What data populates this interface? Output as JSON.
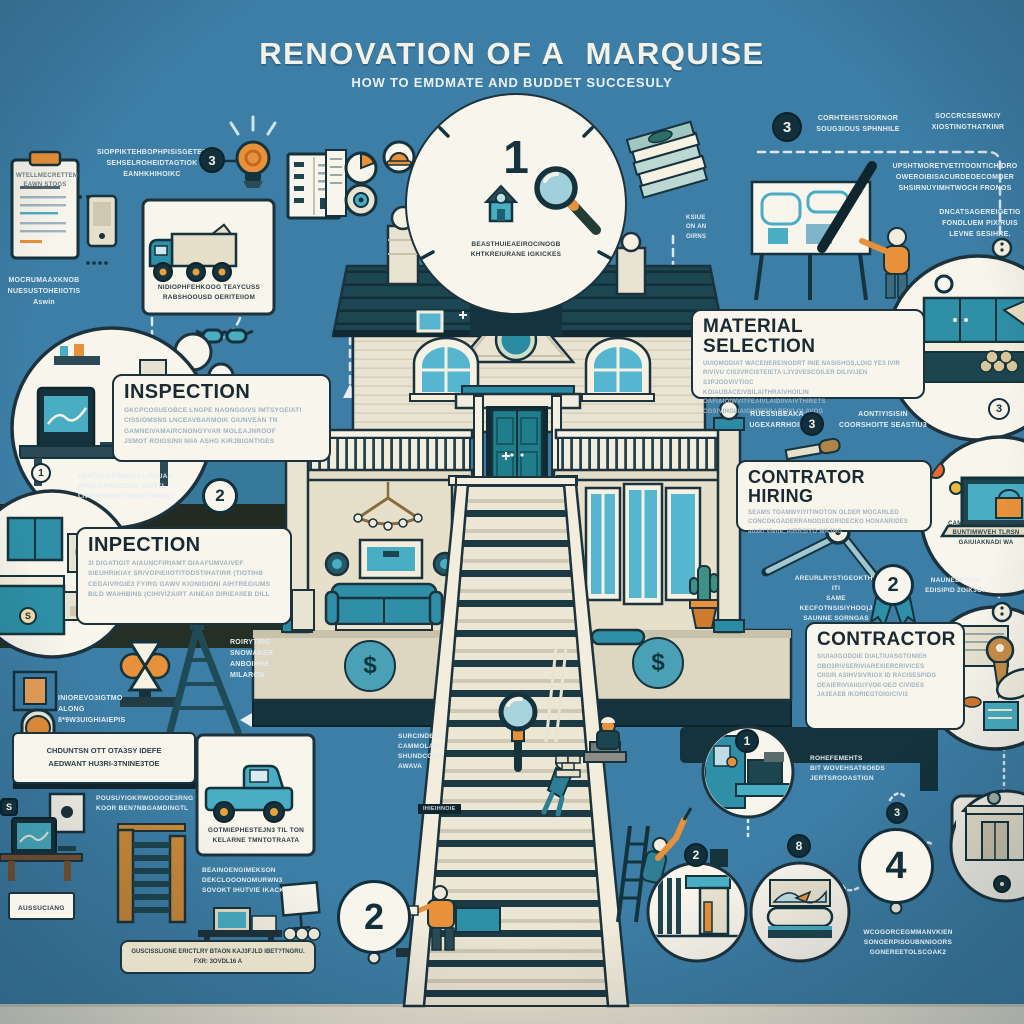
{
  "header": {
    "title": "RENOVATION OF A  MARQUISE",
    "subtitle": "HOW TO EMDMATE AND BUDDET SUCCESULY"
  },
  "badges": {
    "step1": "1",
    "step2": "2",
    "step4": "4",
    "b3_topleft": "3",
    "b3_topright": "3",
    "circle2_left": "2",
    "circle1_small": "1",
    "coin": "S",
    "dollar_square": "S",
    "ribbon2": "2",
    "material3": "3",
    "kitchen3": "3",
    "v1": "1",
    "v2": "2",
    "v8": "8",
    "above4": "3",
    "dollar_left": "$",
    "dollar_right": "$"
  },
  "boxes": {
    "inspection": {
      "title": "INSPECTION",
      "body": "GKCPCOSUEOBCE LNGPE NAONGGIVS IMTSYGEIATI\nCISSIOMSNS LNCEAVBARMOIK GIUNVEAN TN\nGAMNEIVAMAIRCNONGYVAR MOLEAJNROOF\nJSMOT ROIGSINII NIIA ASHG KIRJBIGNTIGES"
    },
    "inpection": {
      "title": "INPECTION",
      "body": "3I DIGATIGIT AIAUNCFIRIAMT DIAAFUMVAIVEF\nSIEUHRIKIAY SR/VOPIEIIOTITODSTIHATIRR (TIOTIHB\nCEGAIVRGIE3 FYIRG GAWV KIONIGIONI AIHTREGIUMS\nBILD WAIHIBINS (CIHIVIZAIRT AINEAII DIRIEAIIEB DILL"
    },
    "material": {
      "title": "MATERIAL SELECTION",
      "body": "UUIOMODIAT WACENEREINODRT INIE NASISHOS,LOIO YE3 IVIR\nRIVIVU CIS3VRCISTEIETA L3Y3VESCOILER DILIVIJEN S3PJOOVIVTIOC\nKOIAUBACEIVBILAITHRAIVHOILIN OAFIAIOIWVITFEAIVLAIDIIVAIVTHIRETS\nCOSIVIHGLIAIGIHNIGILI REIVI GLAVOG"
    },
    "hiring": {
      "title": "CONTRATOR HIRING",
      "body": "SEAMS TOAMWYIYITINOTON OLDER MOCARLED\nCONCOKOADERRANODSEGRIDECKO HONANRIDES\nadakl Viene,        AIRRSIYO WA3NG"
    },
    "contractor": {
      "title": "CONTRACTOR",
      "body": "SIUIAIIGODOIE DIALTIUASGTONIEH\nOBO3RIVSERIVIAREXIERCRIVICES\nCIIGIR ASIHV3IVRIOX ID RACISESPIDG\nOEAIERIVIAIIGIYVOII OEO CIVIDES\nJA3EAEB IKORIEGTOIGICIVI3"
    },
    "notice": {
      "body": "CHDUNTSN OTT OTA3SY IDEFE\nAEDWANT HU3RI-3TNINE3TOE"
    },
    "bottom_bar": {
      "body": "GUSCISSLIGNE ERICTLRY BTAON KAJ3FJLD IBET?TNGRU.\nFXR: 3OVDL16 A"
    },
    "aussuciang": {
      "body": "AUSSUCIANG"
    }
  },
  "labels": {
    "clipboard": "WTELLMECRETTEM\nEAWN STOGS",
    "top_left_note": "SIOPPIKTEHBOPHPISISGETES\nSEHSELROHEIDTAGTIOK\nEANHKHIHOIKC",
    "left_note": "MOCRUMAAXKNOB\nNUESUSTOHEIIOTIS\nAswin",
    "truck1": "NIDIOPHFEHKOOG TEAYCUSS\nRABSHOOUSD OERITEIIOM",
    "step1": "BEASTHUIEAEIROCINOGB\nKHTKREIURANE IGKICKES",
    "tr1": "CORHTEHSTSIORNOR\nSOUG3IOUS SPHNHILE",
    "tr2": "SOCCRCSESWKIY\nXIOSTINGTHATKINR",
    "tr3": "UPSHTMORETVETITOONTICHIDRO\nOWEROIBISACURDEOECOMOER\nSHSIRNUYIMHTWOCH FRONOS",
    "tr4": "DNCATSAGEREIGETIG\nFONDLUEM PIXIRUIS\nLEVNE SESIHRE.",
    "fragment": "KSIUE\nON AN\nOIRNS",
    "band2": "HESTEPOTINSIGIA LITAUAS\nHFMEOTMOCIONA CIATTL\nLIVIEIUOMGITITIEICE WOJU",
    "ladder": "ROIRYTING\nSNOWAKER\nANBOIHRE\nMILARON",
    "lock": "INIOREVO3IGTMO\nALONG 8*9W3UIGHIAIEPIS",
    "stairs_left": "SURCINDENS\nCAMMOLANG\nSHUNDCONN\nAWAVA",
    "tiny_dark": "IHIEIHNOIE",
    "material_left": "RUESSIBEAKA\nUGEXARRHOIR",
    "material_right": "AONTIYISISIN\nCOORSHOITE SEASTIU3",
    "hiring_left": "AREURLRYSTIGEOKTHS ITI\nSAME KECFOTNSISIYHOO)J\nSAUNNE SORNGAS",
    "hiring_right": "NAUNEEPIDUK\nEDISIPID 2OIK3OP",
    "laptop": "CAMOPNTMATW ABJITY\nBUNTIMWVEH TLRSN\nGAIUIAKNADI WA",
    "contractor_notes": "ROHEFEMEHTS\nBIT WOVEHSAT6O6DS\nJERTSROOASTIGN",
    "step4": "WCOGORCEGMMANVKIEN\nSONOERPISOUBNNIOORS\nGONEREETOLSCOAK2",
    "bl_note1": "POUSUYIOKRWOOOOE3RNG\nKOOR BEN7NBGAMDINGTL",
    "truck2": "GOTMIEPHESTEJN3 TIL TON\nKELARNE TMNTOTRAATA",
    "bl_note2": "BEAINOENGIMEKSON\nDEKCLOOONOMURWN3\nSOVOKT IHUTVIE IKACK"
  },
  "colors": {
    "background": "#3d7ea6",
    "ink": "#16323c",
    "cream": "#f8f5ec",
    "accent_teal": "#2e8fa6",
    "accent_orange": "#e8913a",
    "roof": "#1c4651"
  }
}
